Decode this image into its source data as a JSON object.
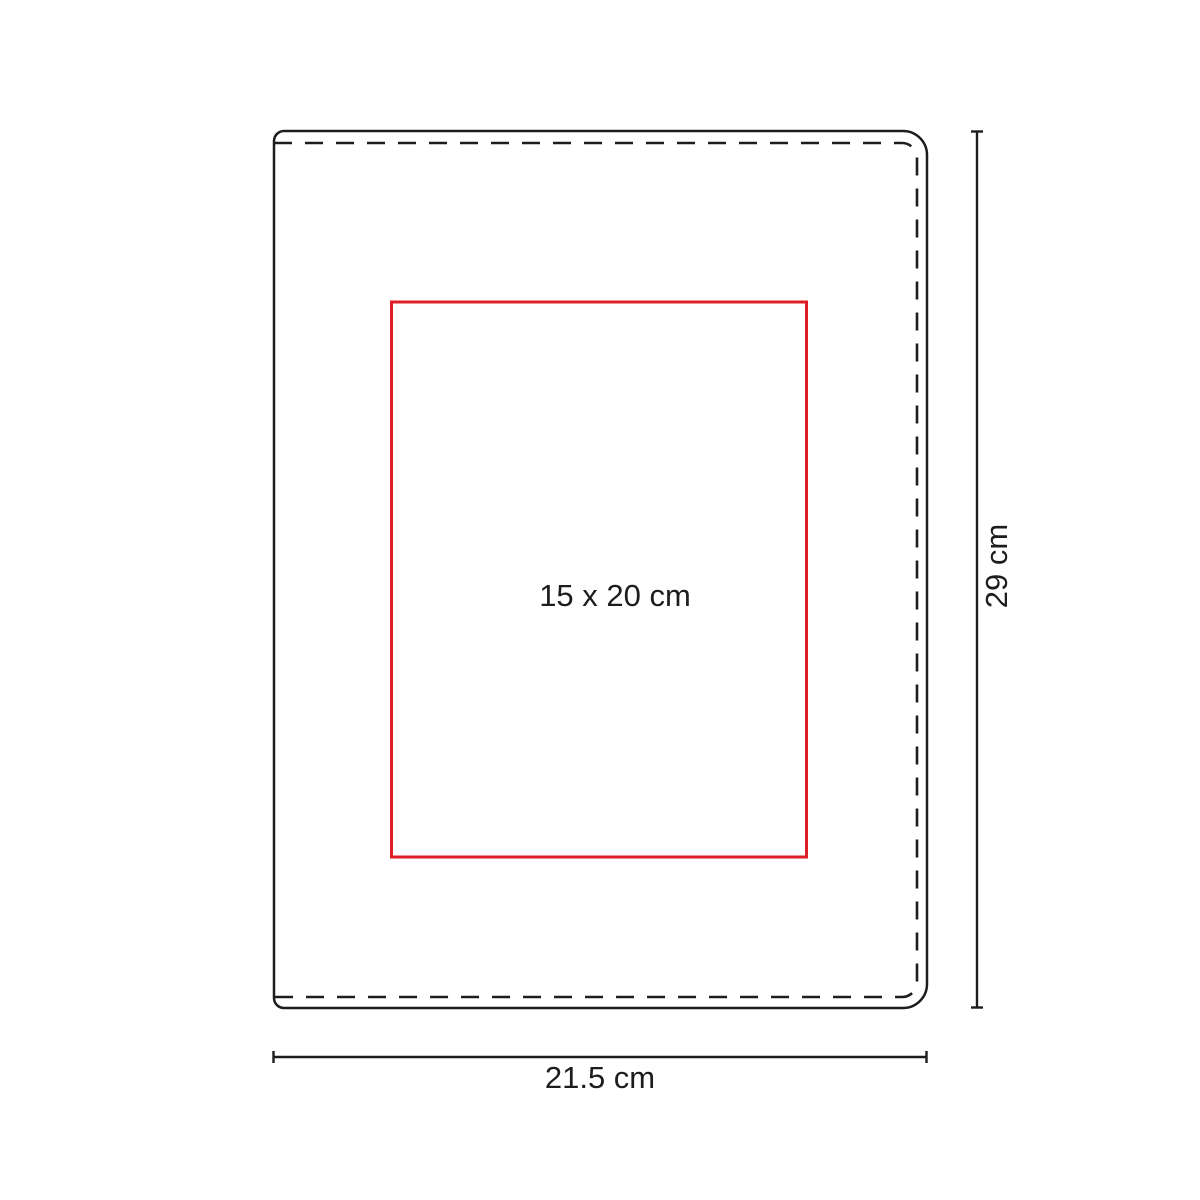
{
  "diagram": {
    "name": "notebook-cover-print-area-diagram",
    "print_area": {
      "label": "15 x 20 cm"
    },
    "dimensions": {
      "height": {
        "label": "29 cm"
      },
      "width": {
        "label": "21.5 cm"
      }
    },
    "colors": {
      "outline": "#1d1d1b",
      "print_area_stroke": "#de1f26",
      "text": "#1d1d1b",
      "background": "#ffffff"
    }
  }
}
